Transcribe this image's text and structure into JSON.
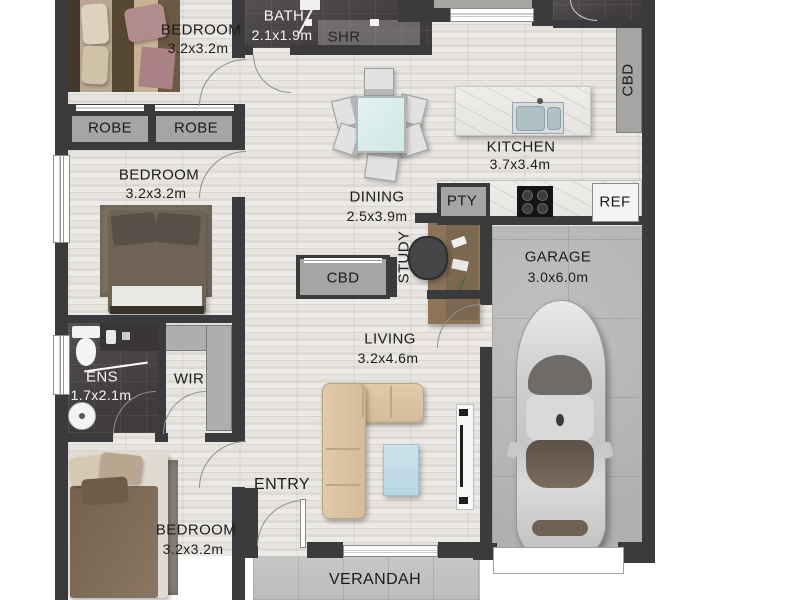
{
  "rooms": {
    "bedroom1": {
      "name": "BEDROOM",
      "dims": "3.2x3.2m"
    },
    "bedroom2": {
      "name": "BEDROOM",
      "dims": "3.2x3.2m"
    },
    "bedroom3": {
      "name": "BEDROOM",
      "dims": "3.2x3.2m"
    },
    "bath": {
      "name": "BATH",
      "dims": "2.1x1.9m"
    },
    "shower": {
      "name": "SHR"
    },
    "kitchen": {
      "name": "KITCHEN",
      "dims": "3.7x3.4m"
    },
    "pantry": {
      "name": "PTY"
    },
    "fridge": {
      "name": "REF"
    },
    "cbd_kitchen": {
      "name": "CBD"
    },
    "cbd_hall": {
      "name": "CBD"
    },
    "robe_left": {
      "name": "ROBE"
    },
    "robe_right": {
      "name": "ROBE"
    },
    "dining": {
      "name": "DINING",
      "dims": "2.5x3.9m"
    },
    "study": {
      "name": "STUDY"
    },
    "living": {
      "name": "LIVING",
      "dims": "3.2x4.6m"
    },
    "garage": {
      "name": "GARAGE",
      "dims": "3.0x6.0m"
    },
    "ensuite": {
      "name": "ENS",
      "dims": "1.7x2.1m"
    },
    "wir": {
      "name": "WIR"
    },
    "entry": {
      "name": "ENTRY"
    },
    "verandah": {
      "name": "VERANDAH"
    }
  },
  "colors": {
    "wall": "#3b3a3c",
    "floor_timber": "#e4e1dd",
    "tile_dark": "#4a4547",
    "cabinet_gray": "#a6a5a3",
    "garage_concrete": "#b9b7b5",
    "verandah_tile": "#c6c5c3",
    "sofa_beige": "#d8c2a1",
    "rug_blue": "#c3dde7",
    "marble_bench": "#eceae7",
    "car_silver": "#cfcfcf",
    "label_dark": "#1c1c1c",
    "label_light": "#f5f5f5"
  }
}
